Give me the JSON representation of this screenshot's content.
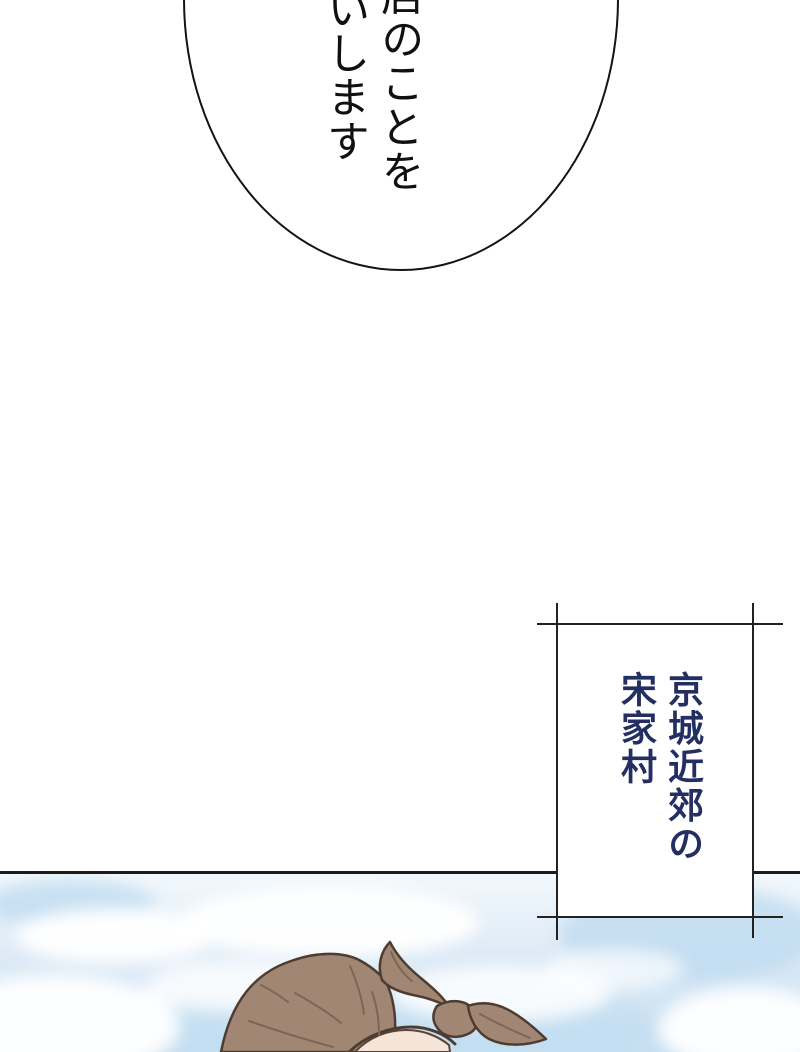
{
  "page": {
    "background_color": "#ffffff",
    "type_label": "manga-page"
  },
  "speech_bubble": {
    "right_column": "店のことを",
    "left_column": "いします",
    "text_color": "#101010",
    "outline_color": "#141414"
  },
  "caption_box": {
    "right_column": "京城近郊の",
    "left_column": "宋家村",
    "text_color": "#232f62",
    "frame_color": "#222222",
    "fill_color": "#ffffff"
  },
  "panel": {
    "divider_color": "#1b1b1b"
  },
  "colors": {
    "sky_top": "#f2f8fc",
    "sky_mid": "#ddeaf6",
    "sky_bottom": "#c6dff2",
    "sky_patch_blue": "#bcd9ef",
    "cloud_white": "#ffffff",
    "bandana_brown": "#a18674",
    "bandana_fold": "#7e6556",
    "bandana_outline": "#4f3c31",
    "skin": "#f7e4d8",
    "skin_edge": "#5a443a"
  }
}
